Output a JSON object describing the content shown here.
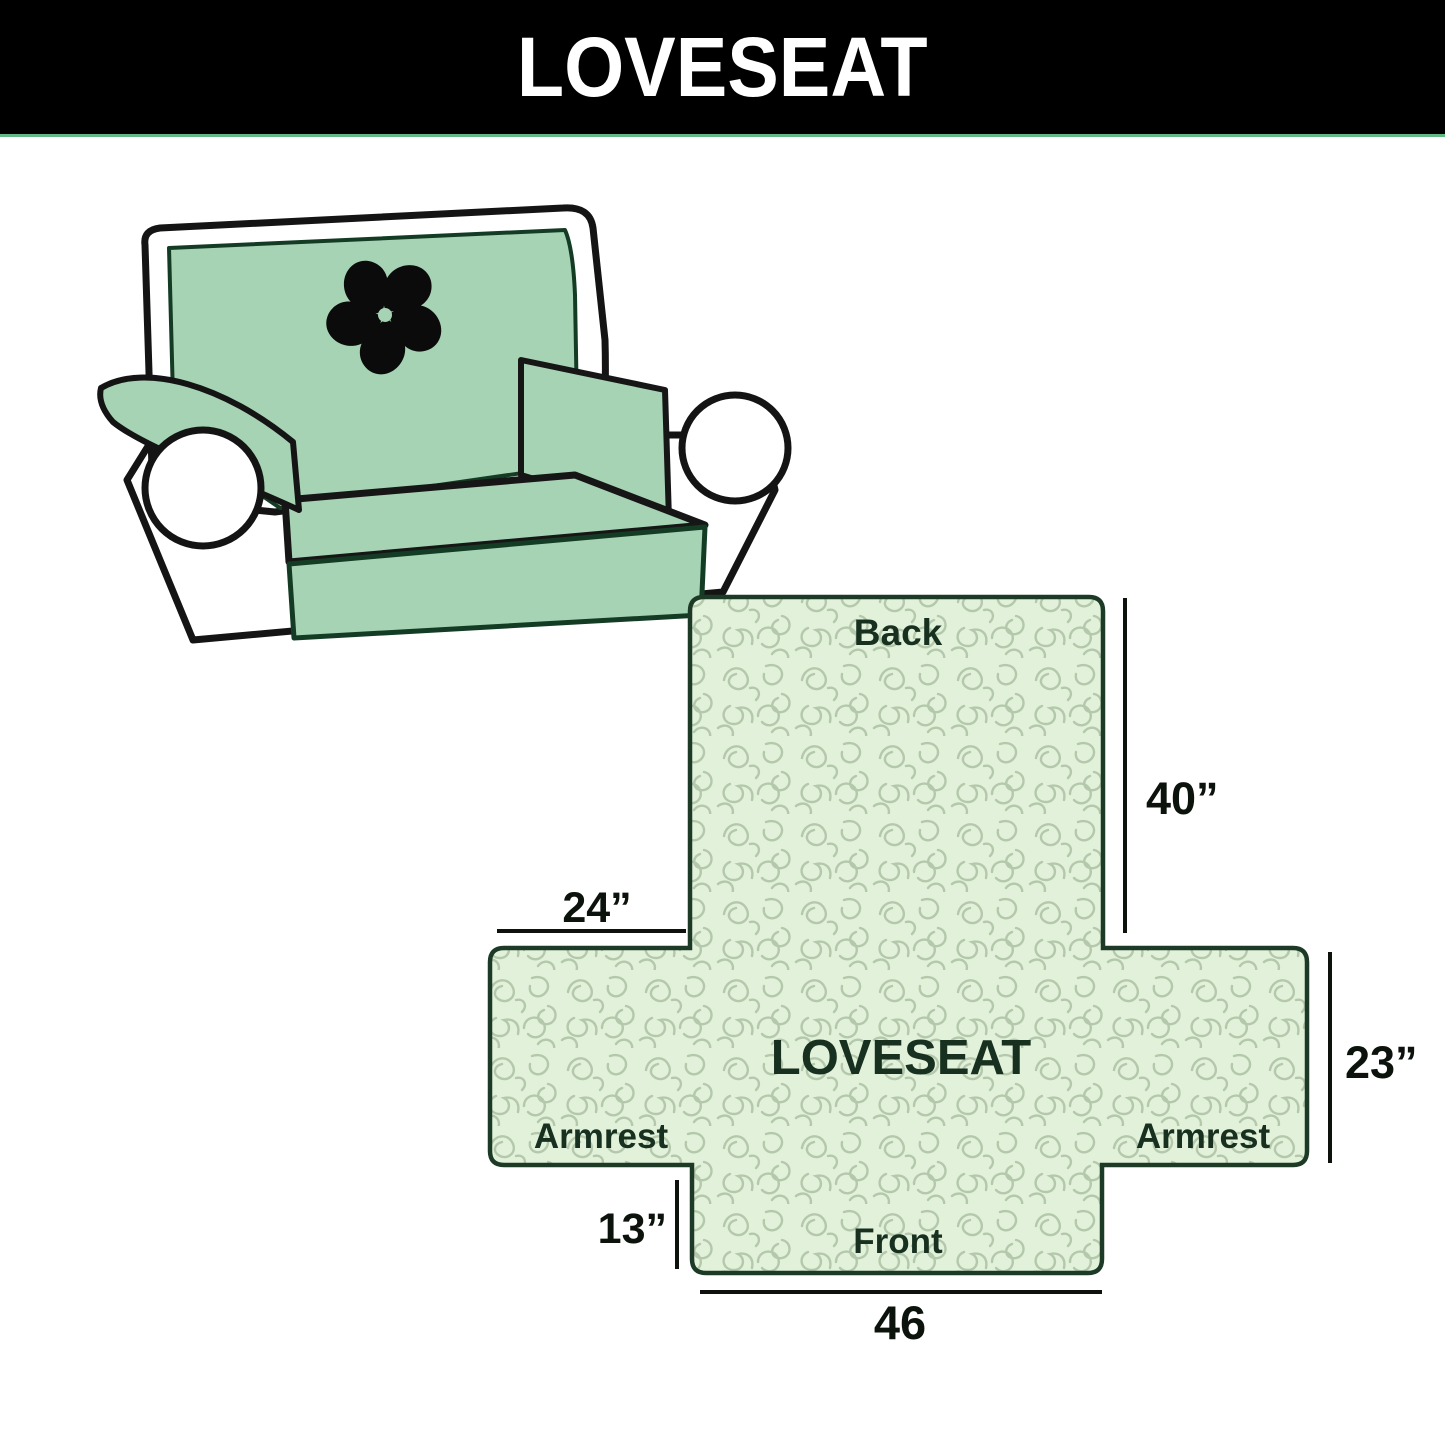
{
  "banner": {
    "title": "LOVESEAT"
  },
  "colors": {
    "banner_bg": "#000000",
    "banner_text": "#ffffff",
    "accent_line_green": "#63b986",
    "cover_green": "#a6d3b4",
    "sofa_outline": "#141414",
    "diagram_fill": "#e2f1da",
    "squiggle": "#b4c9ac",
    "diagram_outline": "#1c3a26",
    "label_dark_green": "#17301f",
    "dimension_text": "#0c120c"
  },
  "sofa": {
    "logo_icon": "pinwheel-icon"
  },
  "diagram": {
    "labels": {
      "back": "Back",
      "front": "Front",
      "armrest_left": "Armrest",
      "armrest_right": "Armrest",
      "center": "LOVESEAT"
    },
    "dimensions": {
      "back_height": "40”",
      "armrest_width": "24”",
      "seat_height": "23”",
      "front_drop": "13”",
      "front_width": "46"
    }
  }
}
